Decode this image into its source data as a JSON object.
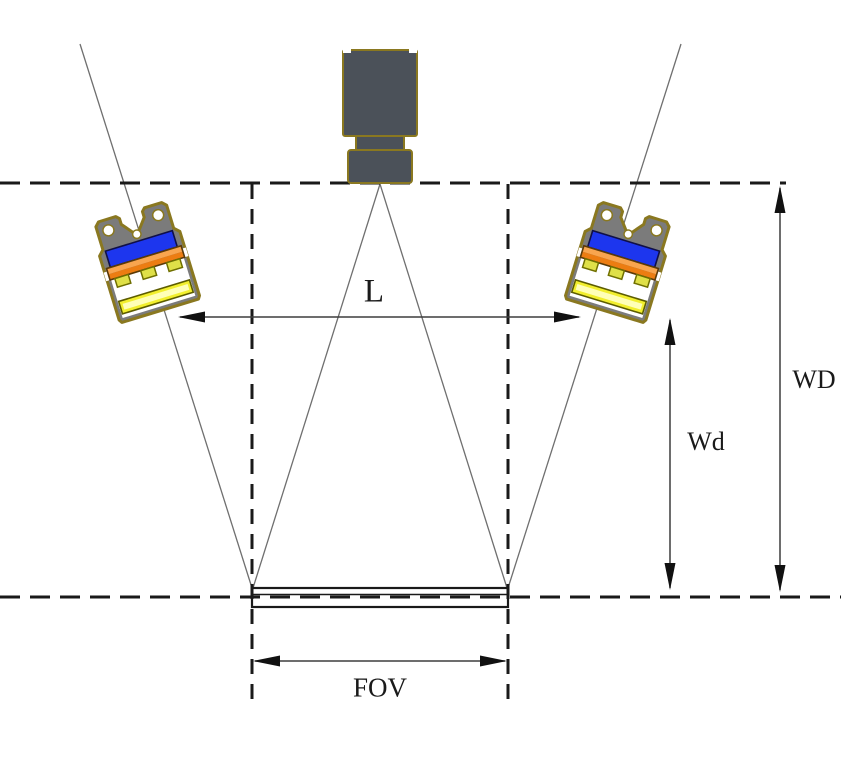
{
  "diagram": {
    "kind": "machine-vision camera and bar-light working distance geometry",
    "labels": {
      "l": "L",
      "wd": "WD",
      "wd_light": "Wd",
      "fov": "FOV"
    },
    "colors": {
      "line_dark": "#1a1a1a",
      "construction_line": "#6f6f6f",
      "camera_body": "#4b5159",
      "metal_edge_gold": "#8a7820",
      "light_housing_gray": "#7b7b7b",
      "pcb_blue": "#1d36ee",
      "led_board_orange_top": "#f8a54e",
      "led_board_orange_bottom": "#ec7d12",
      "led_chip_yellow_green": "#dfe048",
      "diffuser_yellow": "#f2ef2e",
      "diffuser_core": "#ffffb8",
      "cavity_white": "#ffffff"
    }
  }
}
